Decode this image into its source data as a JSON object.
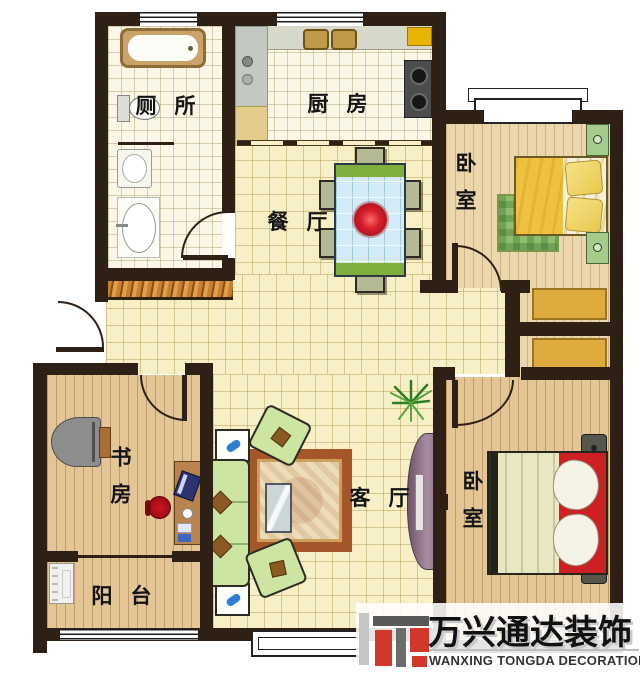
{
  "rooms": {
    "bathroom": {
      "label": "厕所"
    },
    "kitchen": {
      "label": "厨房"
    },
    "dining": {
      "label": "餐厅"
    },
    "bedroom_top": {
      "label": "卧室"
    },
    "bedroom_bottom": {
      "label": "卧室"
    },
    "study": {
      "label": "书房"
    },
    "living": {
      "label": "客厅"
    },
    "balcony": {
      "label": "阳台"
    }
  },
  "watermark": {
    "brand_cn": "万兴通达装饰",
    "brand_en": "WANXING TONGDA DECORATION"
  },
  "palette": {
    "wall": "#2e2014",
    "tile_yellow": "#f7efc6",
    "tile_white": "#fbf7e6",
    "wood_light": "#ecd7ad",
    "wood_tan": "#e3c596",
    "wardrobe_gold": "#dfaa3e",
    "sofa_green": "#cde5a3",
    "accent_red": "#d2372c",
    "table_blue": "#d2ebf6"
  }
}
